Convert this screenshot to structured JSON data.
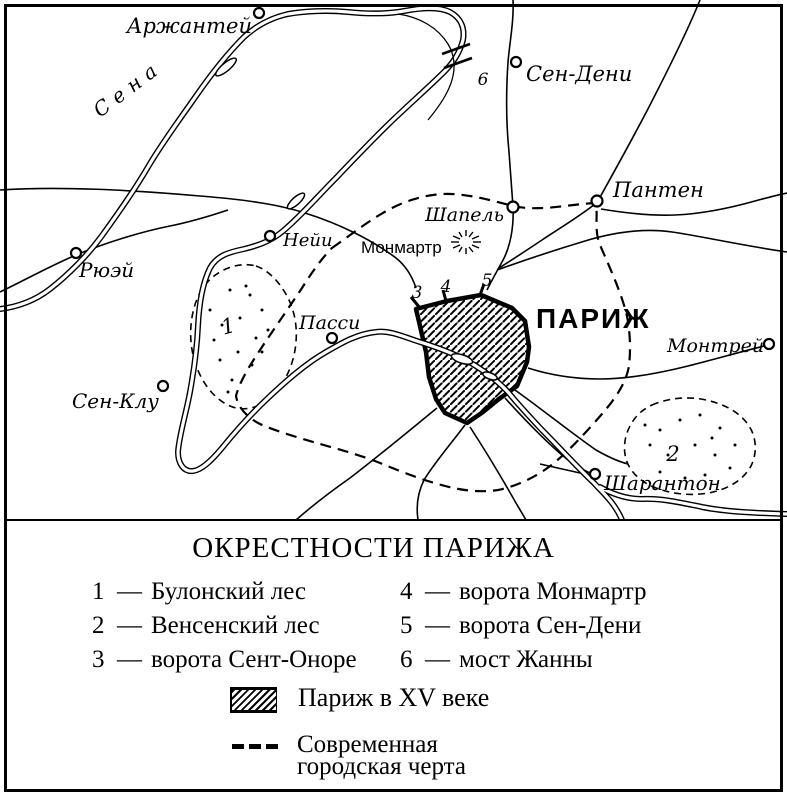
{
  "map": {
    "city_label": "ПАРИЖ",
    "river_label": "Сена",
    "hill_label": "Монмартр",
    "towns": [
      {
        "name": "Аржантей"
      },
      {
        "name": "Сен-Дени"
      },
      {
        "name": "Пантен"
      },
      {
        "name": "Шапель"
      },
      {
        "name": "Нейи"
      },
      {
        "name": "Рюэй"
      },
      {
        "name": "Пасси"
      },
      {
        "name": "Сен-Клу"
      },
      {
        "name": "Монтрей"
      },
      {
        "name": "Шарантон"
      }
    ],
    "numbers": [
      "1",
      "2",
      "3",
      "4",
      "5",
      "6"
    ]
  },
  "legend": {
    "title": "ОКРЕСТНОСТИ ПАРИЖА",
    "dash": "—",
    "items": [
      {
        "num": "1",
        "label": "Булонский лес"
      },
      {
        "num": "2",
        "label": "Венсенский лес"
      },
      {
        "num": "3",
        "label": "ворота Сент-Оноре"
      },
      {
        "num": "4",
        "label": "ворота Монмартр"
      },
      {
        "num": "5",
        "label": "ворота Сен-Дени"
      },
      {
        "num": "6",
        "label": "мост Жанны"
      }
    ],
    "paris_symbol_label": "Париж в XV веке",
    "boundary_label_line1": "Современная",
    "boundary_label_line2": "городская черта"
  },
  "colors": {
    "ink": "#000000",
    "paper": "#ffffff"
  }
}
